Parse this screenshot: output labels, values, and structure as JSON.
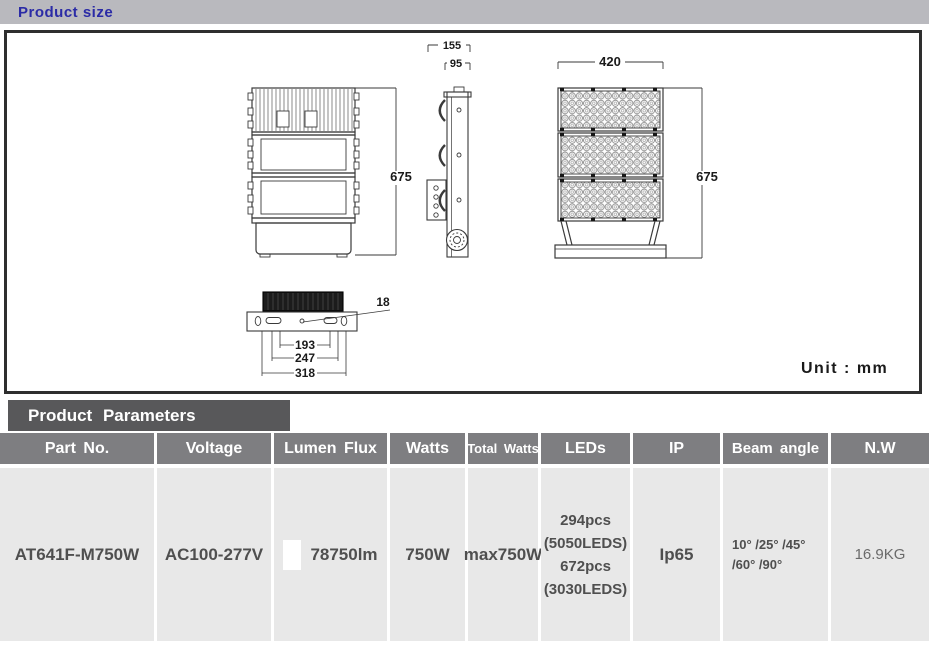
{
  "header": {
    "title": "Product size"
  },
  "drawing": {
    "unit_label": "Unit : mm",
    "dims": {
      "side_total_depth": "155",
      "side_body_depth": "95",
      "front_width": "420",
      "back_height": "675",
      "front_height": "675",
      "mount_hole": "18",
      "mount_span_inner": "193",
      "mount_span_mid": "247",
      "mount_span_outer": "318"
    }
  },
  "parameters": {
    "title": "Product Parameters",
    "columns": [
      "Part No.",
      "Voltage",
      "Lumen Flux",
      "Watts",
      "Total Watts",
      "LEDs",
      "IP",
      "Beam angle",
      "N.W"
    ],
    "row": {
      "part_no": "AT641F-M750W",
      "voltage": "AC100-277V",
      "lumen_flux": "78750lm",
      "watts": "750W",
      "total_watts": "max750W",
      "leds": "294pcs\n(5050LEDS)\n672pcs\n(3030LEDS)",
      "ip": "Ip65",
      "beam_angle": "10° /25° /45°\n/60° /90°",
      "net_weight": "16.9KG"
    }
  }
}
